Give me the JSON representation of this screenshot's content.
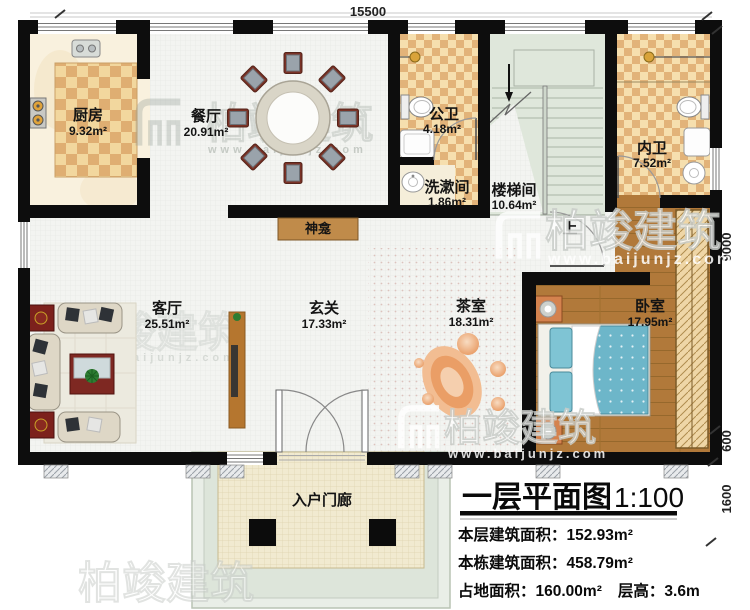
{
  "watermark": {
    "brand": "柏竣建筑",
    "url": "www.baijunjz.com"
  },
  "dimensions": {
    "top": "15500",
    "right_height": "9000",
    "right_wall": "600",
    "right_steps": "1600"
  },
  "rooms": {
    "kitchen": {
      "name": "厨房",
      "area": "9.32m²"
    },
    "dining": {
      "name": "餐厅",
      "area": "20.91m²"
    },
    "public_bath": {
      "name": "公卫",
      "area": "4.18m²"
    },
    "washroom": {
      "name": "洗漱间",
      "area": "1.86m²"
    },
    "stairwell": {
      "name": "楼梯间",
      "area": "10.64m²"
    },
    "inner_bath": {
      "name": "内卫",
      "area": "7.52m²"
    },
    "living": {
      "name": "客厅",
      "area": "25.51m²"
    },
    "foyer": {
      "name": "玄关",
      "area": "17.33m²"
    },
    "tea": {
      "name": "茶室",
      "area": "18.31m²"
    },
    "bedroom": {
      "name": "卧室",
      "area": "17.95m²"
    },
    "porch": {
      "name": "入户门廊"
    },
    "shrine": {
      "name": "神龛"
    },
    "stairs_up_label": "上"
  },
  "titleblock": {
    "title": "一层平面图",
    "scale": "1:100",
    "floor_area_label": "本层建筑面积：",
    "floor_area_value": "152.93m²",
    "total_area_label": "本栋建筑面积：",
    "total_area_value": "458.79m²",
    "footprint_label": "占地面积：",
    "footprint_value": "160.00m²",
    "height_label": "层高：",
    "height_value": "3.6m"
  },
  "colors": {
    "wall": "#0d0d0d",
    "wood_floor": "#b1793a",
    "stair_floor": "#dfe7db",
    "checker_light": "#f6dfae",
    "checker_dark": "#e2b379",
    "bed_blanket": "#6db6c9",
    "shrine_cabinet": "#c08b4a"
  }
}
